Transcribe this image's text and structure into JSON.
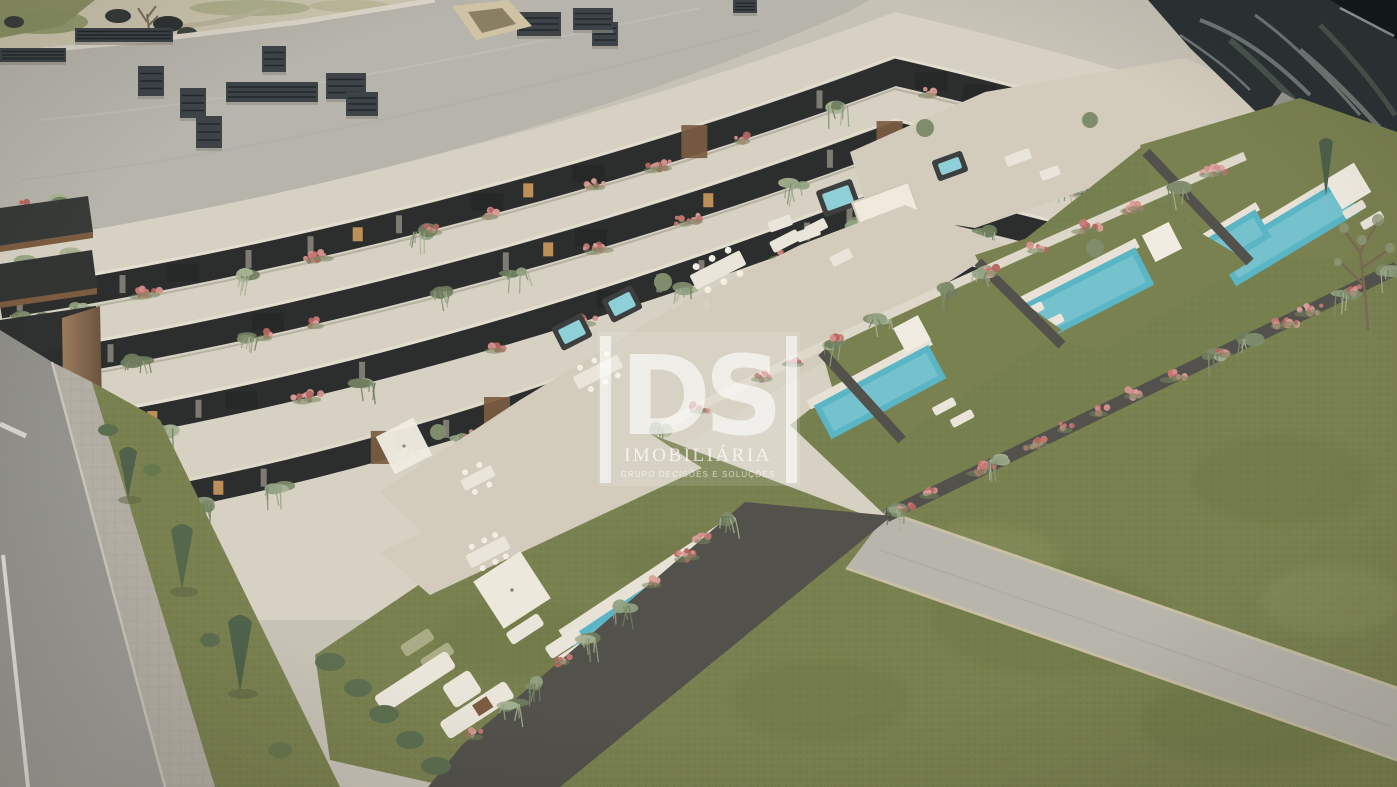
{
  "scene": {
    "type": "architectural-aerial-render",
    "subject": "Aerial 3D rendering of a modern curved apartment building with planted balconies, roof terraces, private lawned gardens with swimming pools, a road and landscaped grounds"
  },
  "watermark": {
    "logo": "DS",
    "brand": "IMOBILIÁRIA",
    "tagline": "GRUPO DECISÕES E SOLUÇÕES",
    "color": "#ffffff"
  },
  "palette": {
    "base": "#c7c2b6",
    "roof": "#b7b4ab",
    "roof_edge": "#dad5c8",
    "chimney": "#3d4347",
    "terrain_sand": "#cbc4ad",
    "terrain_grass": "#8b9164",
    "rock": "#2c3234",
    "facade": "#d7d1c3",
    "terrace_floor": "#d3ccbd",
    "glazing": "#2c2e2d",
    "window_warm": "#cd9b5e",
    "curtain": "#cfc8ba",
    "wood": "#7b5c41",
    "wood_light": "#9c7c5c",
    "plant": "#7f8d6c",
    "plant_light": "#a7b394",
    "flower": "#c57873",
    "parapet": "#ded8ca",
    "wall_dark": "#53514b",
    "lawn": "#7a8150",
    "lawn_slope": "#76804f",
    "lawn_dark": "#68713f",
    "pool": "#5ab5c4",
    "pool_light": "#8fd0d8",
    "deck": "#e7e2d5",
    "road": "#96958f",
    "sidewalk": "#b2aea4",
    "path": "#b8b5ac",
    "conifer": "#4f614a",
    "furniture": "#eae5da",
    "lounger_green": "#a9ac84",
    "road_mark": "#e8e6df"
  }
}
